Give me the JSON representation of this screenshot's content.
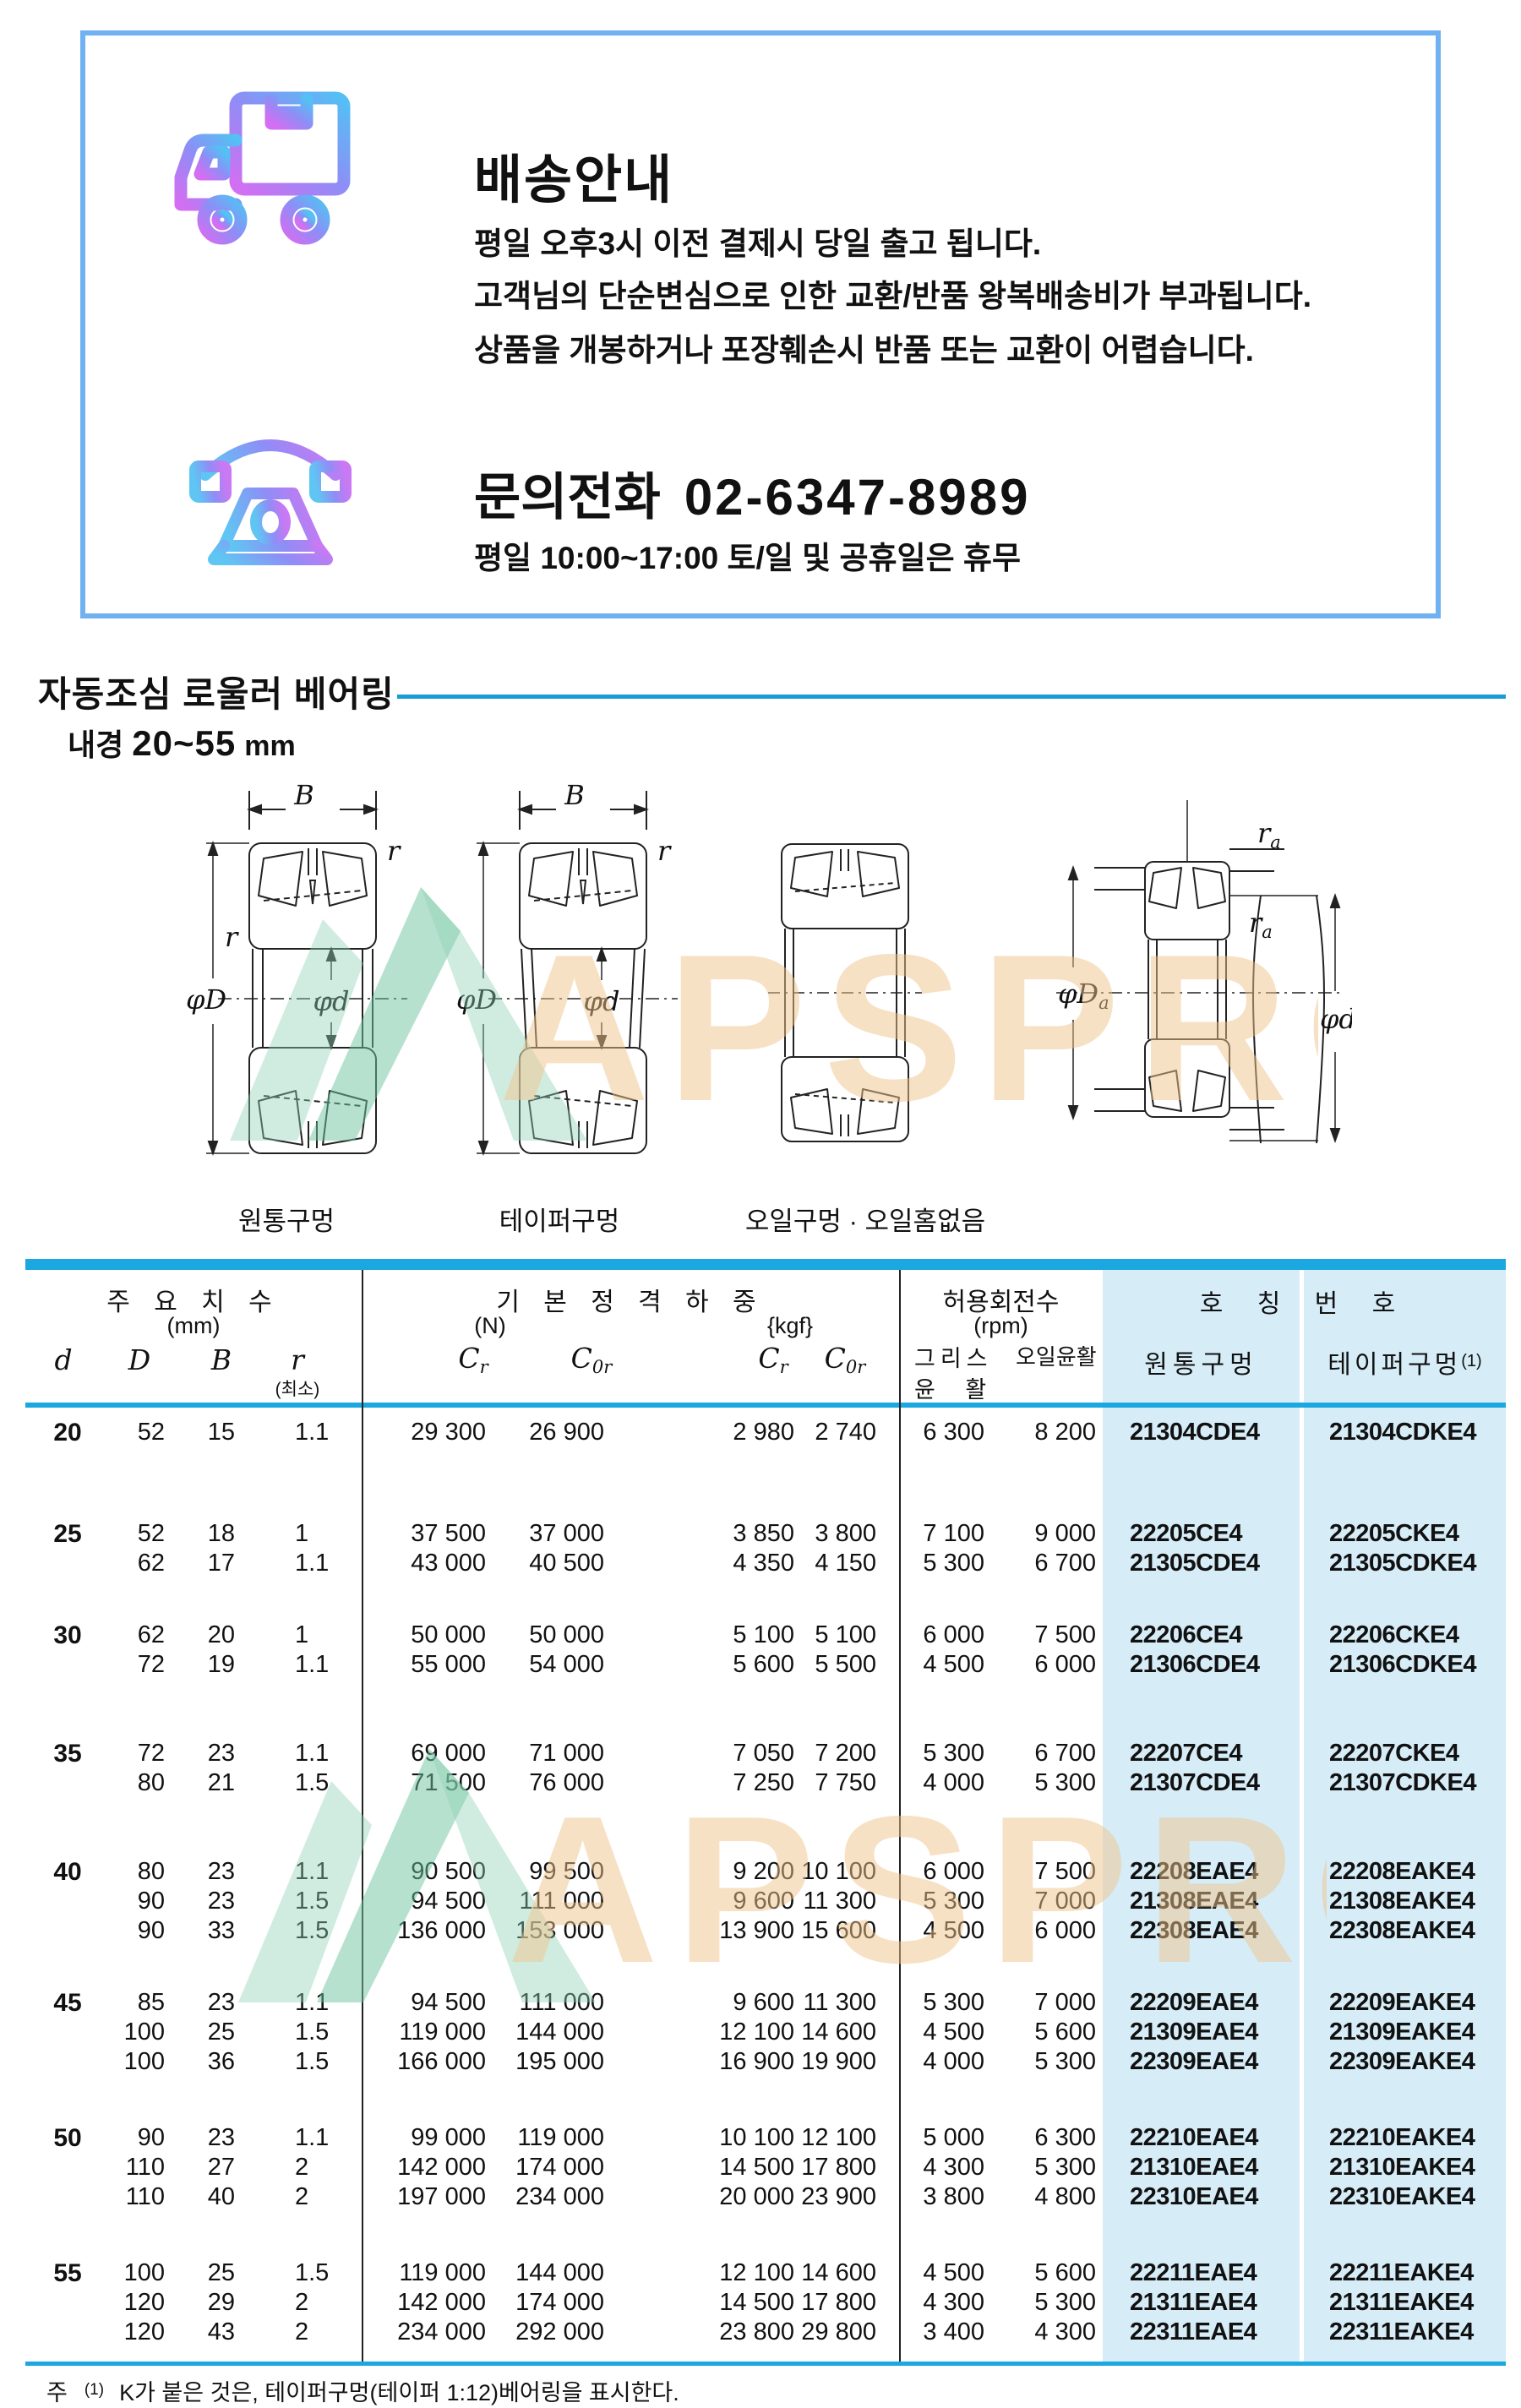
{
  "info_box": {
    "delivery": {
      "title": "배송안내",
      "lines": [
        "평일 오후3시 이전 결제시 당일 출고 됩니다.",
        "고객님의 단순변심으로 인한 교환/반품 왕복배송비가 부과됩니다.",
        "상품을 개봉하거나 포장훼손시 반품 또는 교환이 어렵습니다."
      ]
    },
    "phone": {
      "title": "문의전화",
      "number": "02-6347-8989",
      "hours": "평일 10:00~17:00 토/일 및 공휴일은 휴무"
    }
  },
  "section": {
    "title": "자동조심 로울러 베어링",
    "bore_label": "내경",
    "bore_range": "20~55",
    "bore_unit": "mm"
  },
  "diagrams": {
    "bore_types": [
      "원통구멍",
      "테이퍼구멍",
      "오일구멍 · 오일홈없음"
    ],
    "dims": {
      "B": "B",
      "r": "r",
      "phiD": "φD",
      "phid": "φd",
      "sub_a": "a"
    }
  },
  "watermark": {
    "text": "APSPRO"
  },
  "table": {
    "headers": {
      "dims": {
        "title": "주 요 치 수",
        "unit": "(mm)",
        "d": "d",
        "D": "D",
        "B": "B",
        "r": "r",
        "r_note": "(최소)"
      },
      "load": {
        "title": "기 본 정 격 하 중",
        "unit_n": "(N)",
        "unit_kgf": "{kgf}",
        "C": "C",
        "sub_r": "r",
        "sub_0r": "0r"
      },
      "speed": {
        "title": "허용회전수",
        "unit": "(rpm)",
        "grease_l1": "그리스",
        "grease_l2": "윤 활",
        "oil": "오일윤활"
      },
      "part": {
        "title": "호 칭 번 호",
        "cyl": "원통구멍",
        "taper": "테이퍼구멍",
        "taper_sup": "(1)"
      }
    },
    "groups": [
      {
        "d": "20",
        "rows": [
          [
            "52",
            "15",
            "1.1",
            "29 300",
            "26 900",
            "2 980",
            "2 740",
            "6 300",
            "8 200",
            "21304CDE4",
            "21304CDKE4"
          ]
        ]
      },
      {
        "d": "25",
        "rows": [
          [
            "52",
            "18",
            "1",
            "37 500",
            "37 000",
            "3 850",
            "3 800",
            "7 100",
            "9 000",
            "22205CE4",
            "22205CKE4"
          ],
          [
            "62",
            "17",
            "1.1",
            "43 000",
            "40 500",
            "4 350",
            "4 150",
            "5 300",
            "6 700",
            "21305CDE4",
            "21305CDKE4"
          ]
        ]
      },
      {
        "d": "30",
        "rows": [
          [
            "62",
            "20",
            "1",
            "50 000",
            "50 000",
            "5 100",
            "5 100",
            "6 000",
            "7 500",
            "22206CE4",
            "22206CKE4"
          ],
          [
            "72",
            "19",
            "1.1",
            "55 000",
            "54 000",
            "5 600",
            "5 500",
            "4 500",
            "6 000",
            "21306CDE4",
            "21306CDKE4"
          ]
        ]
      },
      {
        "d": "35",
        "rows": [
          [
            "72",
            "23",
            "1.1",
            "69 000",
            "71 000",
            "7 050",
            "7 200",
            "5 300",
            "6 700",
            "22207CE4",
            "22207CKE4"
          ],
          [
            "80",
            "21",
            "1.5",
            "71 500",
            "76 000",
            "7 250",
            "7 750",
            "4 000",
            "5 300",
            "21307CDE4",
            "21307CDKE4"
          ]
        ]
      },
      {
        "d": "40",
        "rows": [
          [
            "80",
            "23",
            "1.1",
            "90 500",
            "99 500",
            "9 200",
            "10 100",
            "6 000",
            "7 500",
            "22208EAE4",
            "22208EAKE4"
          ],
          [
            "90",
            "23",
            "1.5",
            "94 500",
            "111 000",
            "9 600",
            "11 300",
            "5 300",
            "7 000",
            "21308EAE4",
            "21308EAKE4"
          ],
          [
            "90",
            "33",
            "1.5",
            "136 000",
            "153 000",
            "13 900",
            "15 600",
            "4 500",
            "6 000",
            "22308EAE4",
            "22308EAKE4"
          ]
        ]
      },
      {
        "d": "45",
        "rows": [
          [
            "85",
            "23",
            "1.1",
            "94 500",
            "111 000",
            "9 600",
            "11 300",
            "5 300",
            "7 000",
            "22209EAE4",
            "22209EAKE4"
          ],
          [
            "100",
            "25",
            "1.5",
            "119 000",
            "144 000",
            "12 100",
            "14 600",
            "4 500",
            "5 600",
            "21309EAE4",
            "21309EAKE4"
          ],
          [
            "100",
            "36",
            "1.5",
            "166 000",
            "195 000",
            "16 900",
            "19 900",
            "4 000",
            "5 300",
            "22309EAE4",
            "22309EAKE4"
          ]
        ]
      },
      {
        "d": "50",
        "rows": [
          [
            "90",
            "23",
            "1.1",
            "99 000",
            "119 000",
            "10 100",
            "12 100",
            "5 000",
            "6 300",
            "22210EAE4",
            "22210EAKE4"
          ],
          [
            "110",
            "27",
            "2",
            "142 000",
            "174 000",
            "14 500",
            "17 800",
            "4 300",
            "5 300",
            "21310EAE4",
            "21310EAKE4"
          ],
          [
            "110",
            "40",
            "2",
            "197 000",
            "234 000",
            "20 000",
            "23 900",
            "3 800",
            "4 800",
            "22310EAE4",
            "22310EAKE4"
          ]
        ]
      },
      {
        "d": "55",
        "rows": [
          [
            "100",
            "25",
            "1.5",
            "119 000",
            "144 000",
            "12 100",
            "14 600",
            "4 500",
            "5 600",
            "22211EAE4",
            "22211EAKE4"
          ],
          [
            "120",
            "29",
            "2",
            "142 000",
            "174 000",
            "14 500",
            "17 800",
            "4 300",
            "5 300",
            "21311EAE4",
            "21311EAKE4"
          ],
          [
            "120",
            "43",
            "2",
            "234 000",
            "292 000",
            "23 800",
            "29 800",
            "3 400",
            "4 300",
            "22311EAE4",
            "22311EAKE4"
          ]
        ]
      }
    ]
  },
  "footnote": {
    "prefix": "주",
    "sup": "(1)",
    "text": "K가 붙은 것은, 테이퍼구멍(테이퍼 1:12)베어링을 표시한다."
  },
  "colors": {
    "accent_blue": "#1ba7e0",
    "panel_blue": "#d6ecf7",
    "box_border_blue": "#6fb1f1",
    "rule_blue": "#1a9ad6",
    "watermark_orange": "#f0c48c",
    "watermark_green": "#8fd2b4",
    "icon_gradient_purple": "#c96ef2",
    "icon_gradient_blue": "#54c0f4"
  }
}
